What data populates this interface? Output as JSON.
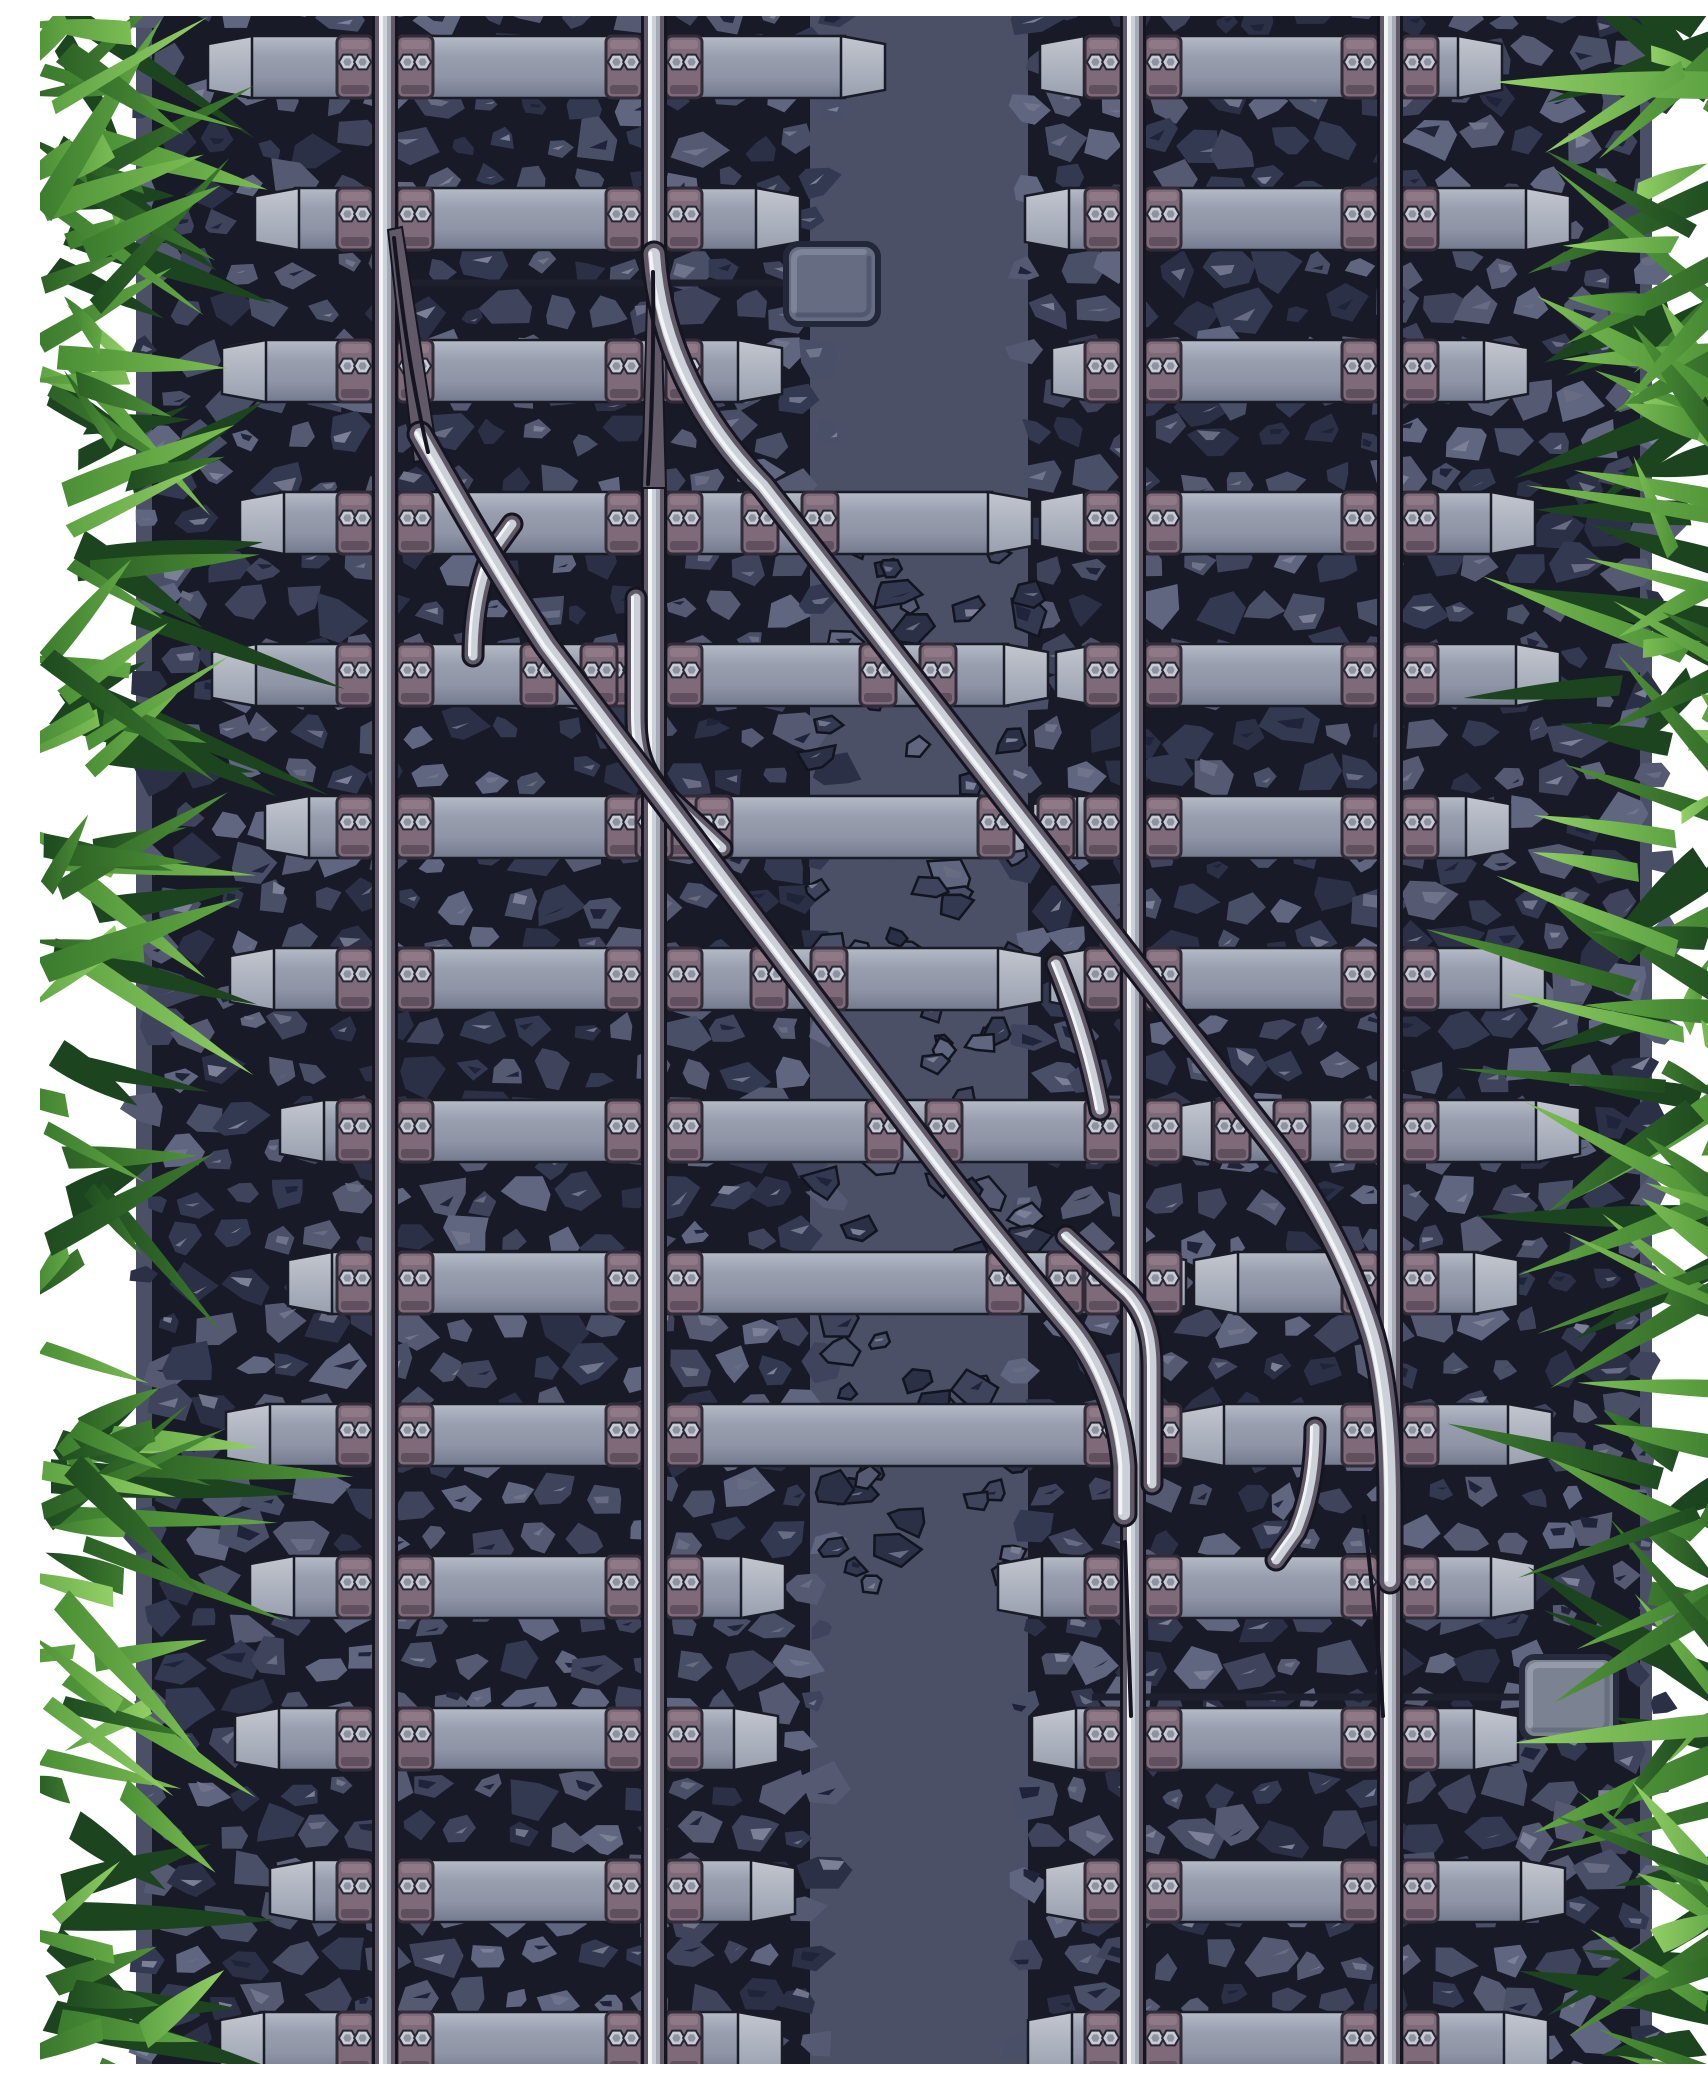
{
  "meta": {
    "description": "Top view vector illustration of two parallel railway tracks with a diagonal crossover switch, ballast rocks, sleepers with bolted baseplates, two switch motor boxes and grass along both edges"
  },
  "scene": {
    "width": 1708,
    "height": 2048,
    "seed": 1337,
    "colors": {
      "bg": "#ffffff",
      "slab": "#4b5066",
      "bandDark": "#181a27",
      "rockBase": [
        "#343952",
        "#3f445c",
        "#4a4f68",
        "#555a72",
        "#2c3047",
        "#606580"
      ],
      "rockLight": [
        "#6f748b",
        "#7b8096",
        "#676c83"
      ],
      "rockDark": "#20243a",
      "centerRockStroke": "#12141f",
      "tieGrad": [
        "#b6bbc7",
        "#989eae",
        "#8f95a6",
        "#747a8e"
      ],
      "capGrad": [
        "#c2c6d0",
        "#9aa0af"
      ],
      "tieStroke": "#191b26",
      "plate": {
        "fill": "#7e6a78",
        "stroke": "#322b38",
        "top": "#8f7987",
        "bottom": "#604f5f",
        "boltFill": "#c9ccd4",
        "boltInner": "#8e93a1",
        "boltStroke": "#262836"
      },
      "rail": {
        "outline": "#141520",
        "web": "#615868",
        "head": "#ccd0d8",
        "white": "#f3f4f6",
        "shade": "#a6aab6"
      },
      "rod": "#1d1f2c",
      "grassBack": "#1c451f",
      "grassGrads": [
        [
          "#1f4b20",
          "#3c7a2e"
        ],
        [
          "#2c6125",
          "#4f9338"
        ],
        [
          "#3a7b2d",
          "#63a844"
        ],
        [
          "#4a8f35",
          "#7cbd54"
        ],
        [
          "#5ea343",
          "#92cf66"
        ]
      ]
    },
    "ballast": {
      "slab": [
        96,
        0,
        1516,
        2048
      ],
      "bands": [
        [
          112,
          770
        ],
        [
          988,
          1600
        ]
      ],
      "grid": 48,
      "center": {
        "x0": 772,
        "x1": 990,
        "y0": 530,
        "y1": 1590,
        "count": 90
      }
    },
    "sleepers": {
      "height": 66,
      "capWidth": 44,
      "rows": [
        [
          18,
          [
            [
              168,
              845
            ],
            [
              1000,
              1462
            ]
          ]
        ],
        [
          170,
          [
            [
              215,
              760
            ],
            [
              985,
              1530
            ]
          ]
        ],
        [
          322,
          [
            [
              182,
              742
            ],
            [
              1012,
              1488
            ]
          ]
        ],
        [
          474,
          [
            [
              200,
              992
            ],
            [
              1000,
              1495
            ]
          ]
        ],
        [
          626,
          [
            [
              172,
              1008
            ],
            [
              1016,
              1520
            ]
          ]
        ],
        [
          778,
          [
            [
              225,
              985
            ],
            [
              993,
              1470
            ]
          ]
        ],
        [
          930,
          [
            [
              190,
              1002
            ],
            [
              1010,
              1505
            ]
          ]
        ],
        [
          1082,
          [
            [
              240,
              1120
            ],
            [
              1128,
              1540
            ]
          ]
        ],
        [
          1234,
          [
            [
              248,
              1146
            ],
            [
              1154,
              1478
            ]
          ]
        ],
        [
          1386,
          [
            [
              186,
              1132
            ],
            [
              1140,
              1512
            ]
          ]
        ],
        [
          1538,
          [
            [
              210,
              745
            ],
            [
              958,
              1495
            ]
          ]
        ],
        [
          1690,
          [
            [
              195,
              738
            ],
            [
              992,
              1478
            ]
          ]
        ],
        [
          1842,
          [
            [
              230,
              755
            ],
            [
              1005,
              1525
            ]
          ]
        ],
        [
          1994,
          [
            [
              180,
              742
            ],
            [
              988,
              1508
            ]
          ]
        ]
      ]
    },
    "rails": {
      "xs": [
        345,
        614,
        1093,
        1350
      ],
      "segments": {
        "614": [
          [
            -20,
            248
          ],
          [
            472,
            2068
          ]
        ]
      },
      "plateOffsets": [
        -48,
        12
      ],
      "plateSize": [
        36,
        62
      ]
    },
    "crossover": {
      "P": "M 614,238 C 620,330 662,408 723,470 L 1232,1126 C 1274,1180 1312,1252 1332,1318 C 1346,1366 1350,1430 1350,1490 L 1350,1565",
      "Q": "M 380,418 C 414,478 458,556 507,630 L 900,1150 C 938,1200 986,1258 1028,1308 C 1060,1346 1080,1398 1084,1450 L 1084,1498",
      "stubs": [
        "M 433,640 C 433,600 439,566 452,536 L 472,508",
        "M 596,582 L 596,700 C 596,734 603,755 620,774 L 682,832",
        "M 1112,1468 L 1112,1352 C 1112,1318 1105,1297 1088,1278 L 1026,1220",
        "M 1275,1412 C 1275,1452 1269,1486 1256,1516 L 1236,1544",
        "M 1016,948 C 1036,996 1051,1044 1060,1094"
      ],
      "wedges": [
        "348,214 362,211 398,442 374,446",
        "608,248 620,248 626,472 602,472"
      ],
      "thinLines": [
        "M 354,222 C 362,300 373,372 388,436",
        "M 613,256 C 614,330 612,402 608,468",
        "M 1085,1526 C 1087,1580 1089,1640 1091,1700",
        "M 1324,1500 C 1332,1568 1339,1636 1343,1700"
      ],
      "diagPlates": [
        [
          507,
          750
        ],
        [
          659,
          868
        ],
        [
          811,
          986
        ],
        [
          1115,
          1222
        ],
        [
          659,
          529
        ],
        [
          811,
          644
        ],
        [
          963,
          759
        ],
        [
          1115,
          874
        ],
        [
          1267,
          995
        ]
      ]
    },
    "equipment": {
      "boxes": [
        {
          "x": 746,
          "y": 228,
          "w": 92,
          "h": 80,
          "fill": "#666c81",
          "stroke": "#23273a",
          "hi": "#7d8398",
          "lo": "#525870"
        },
        {
          "x": 1482,
          "y": 1641,
          "w": 94,
          "h": 82,
          "fill": "#7b8292",
          "stroke": "#272b3d",
          "hi": "#959baa",
          "lo": "#676e80"
        }
      ],
      "rods": [
        [
          368,
          267,
          752
        ],
        [
          1052,
          1681,
          1486
        ]
      ]
    },
    "grass": {
      "leafCount": 105,
      "backCount": 32,
      "leftBaseMax": 125,
      "inwardRatio": 0.72,
      "lenMin": 75,
      "lenVar": 150,
      "widMin": 13,
      "widVar": 15
    }
  }
}
